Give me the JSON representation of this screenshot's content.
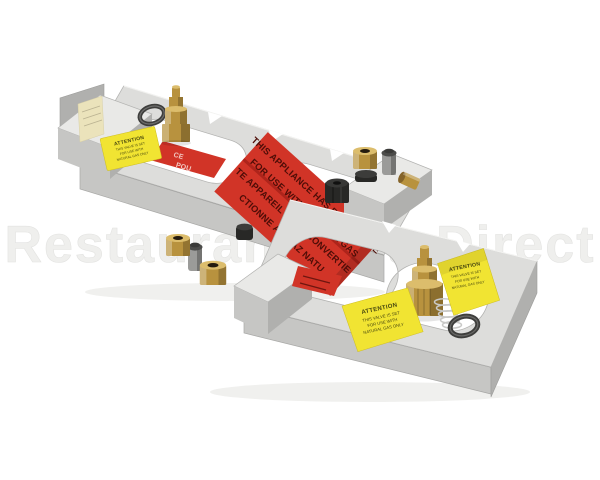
{
  "scene": {
    "description": "Product photo of a stainless steel natural gas conversion kit: two stamped metal burner brackets arranged diagonally with brass orifice fittings, O-rings, a spring, black caps, yellow ATTENTION labels and a red conversion warning label",
    "background": "#ffffff"
  },
  "watermark": {
    "text": "RestaurantPartsDirect"
  },
  "red_label": {
    "lines": [
      "THIS APPLIANCE HAS BEEN CONVE",
      "FOR USE WITH NATURAL GAS",
      "TE APPAREIL A ETE CONVERTIE",
      "CTIONNE  AU GAZ NATU"
    ]
  },
  "red_label_under": {
    "lines": [
      "CE",
      "POU"
    ]
  },
  "attention_label": {
    "title": "ATTENTION",
    "lines": [
      "THIS VALVE IS SET",
      "FOR USE WITH",
      "NATURAL GAS ONLY"
    ]
  },
  "colors": {
    "metal_top": "#dddddb",
    "metal_top_light": "#e9e9e7",
    "metal_front": "#c6c6c4",
    "metal_side": "#b0b0ae",
    "metal_edge": "#9c9c9a",
    "brass": "#b8923e",
    "brass_light": "#dcbd6c",
    "brass_dark": "#85642a",
    "red_label": "#d13427",
    "red_text": "#4e0d07",
    "red_under_text": "#f2c9c2",
    "yellow_label": "#f1e432",
    "yellow_text": "#474710",
    "oring": "#3e3e3c",
    "spring": "#c9c9c7",
    "cylinder": "#9b9b99",
    "cylinder_dark": "#4c4c4a",
    "black_part": "#282826",
    "pale_label": "#ebe3bb",
    "watermark": "#efefed"
  }
}
